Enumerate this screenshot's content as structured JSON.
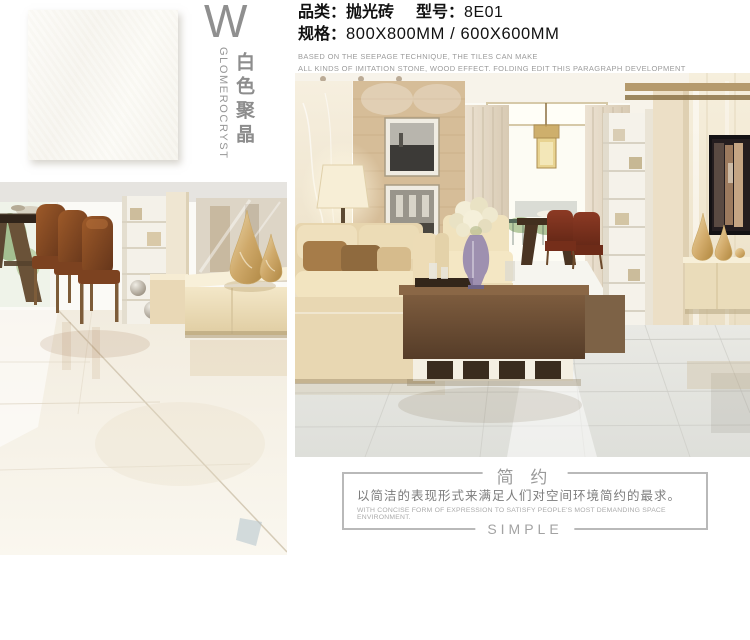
{
  "brand": {
    "letter": "W",
    "name_en": "GLOMEROCRYST",
    "name_cn": "白色聚晶"
  },
  "product": {
    "category_label": "品类：",
    "category_value": "抛光砖",
    "model_label": "型号：",
    "model_value": "8E01",
    "spec_label": "规格：",
    "spec_value": "800X800MM / 600X600MM",
    "desc_line1": "BASED ON THE SEEPAGE TECHNIQUE, THE TILES CAN MAKE",
    "desc_line2": "ALL KINDS OF IMITATION STONE, WOOD EFFECT. FOLDING EDIT THIS PARAGRAPH DEVELOPMENT"
  },
  "footer": {
    "title_cn": "简 约",
    "desc_cn": "以简洁的表现形式来满足人们对空间环境简约的最求。",
    "desc_en": "WITH CONCISE FORM OF EXPRESSION TO SATISFY PEOPLE'S MOST DEMANDING SPACE ENVIRONMENT.",
    "title_en": "SIMPLE"
  },
  "colors": {
    "accent_gray": "#949494",
    "border_gray": "#b9b9b9",
    "text_black": "#111111",
    "muted_gray": "#9c9c9c"
  }
}
